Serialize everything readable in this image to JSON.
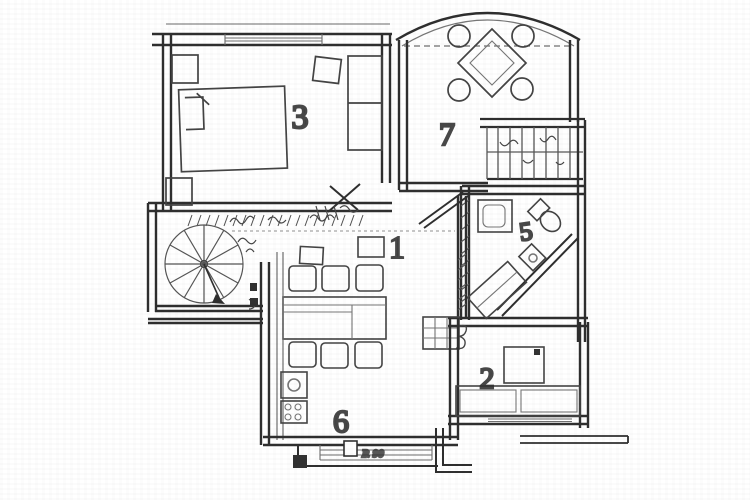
{
  "colors": {
    "paper": "#ffffff",
    "ink": "#383838",
    "ink_light": "#707070"
  },
  "rooms": [
    {
      "label": "3"
    },
    {
      "label": "7"
    },
    {
      "label": "1"
    },
    {
      "label": "5"
    },
    {
      "label": "2"
    },
    {
      "label": "6"
    }
  ],
  "annotations": [
    {
      "text": "P. 90"
    }
  ]
}
